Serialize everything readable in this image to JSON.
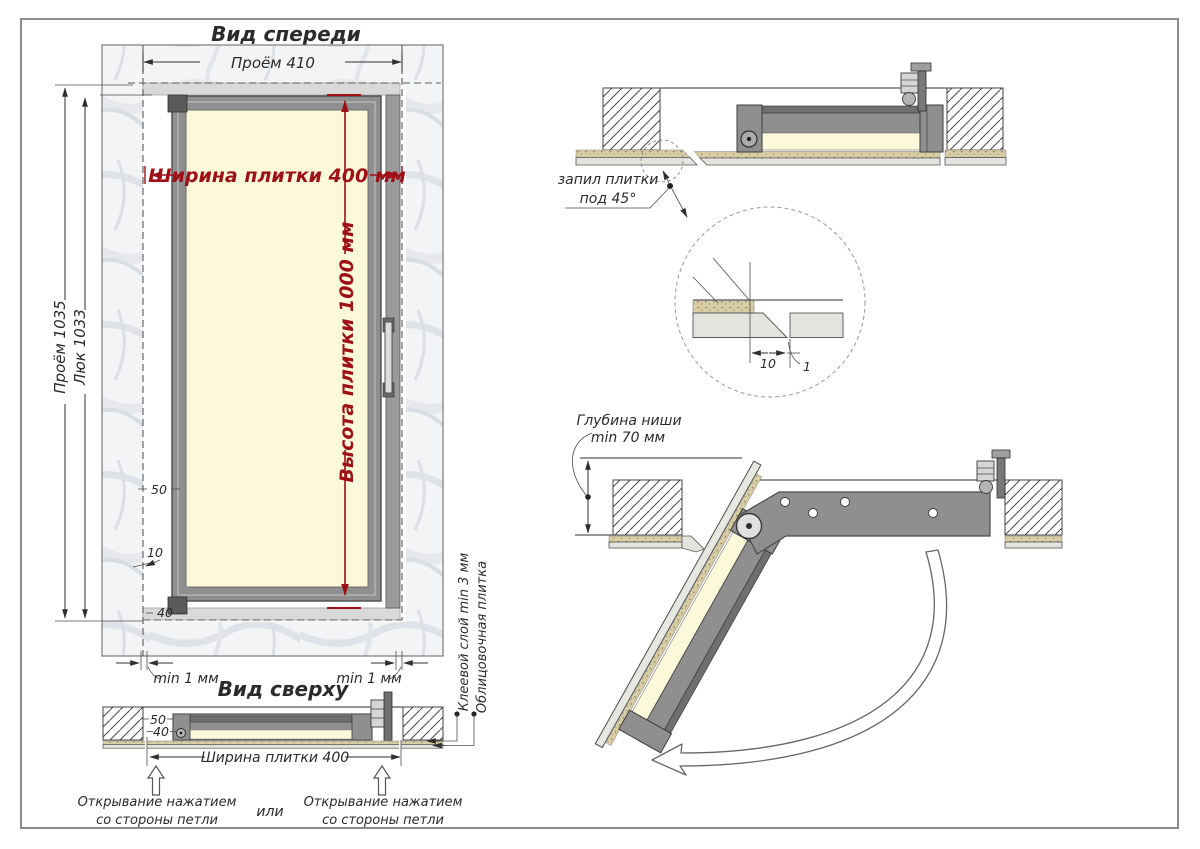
{
  "colors": {
    "red": "#9e1016",
    "frame_gray": "#8f8f8f",
    "frame_dark": "#4b4b4b",
    "cream": "#fcf8da",
    "tile_gray": "#e4e4df",
    "adhesive_tan": "#d9cda6",
    "marble_base": "#f4f5f7",
    "line": "#2f2f2f"
  },
  "front_view": {
    "title": "Вид спереди",
    "dim_opening_width": "Проём 410",
    "dim_tile_width": "Ширина плитки 400 мм",
    "dim_tile_height": "Высота плитки 1000 мм",
    "dim_opening_height": "Проём 1035",
    "dim_hatch_height": "Люк 1033",
    "dim_50": "50",
    "dim_10": "10",
    "dim_40": "40",
    "gap_left": "min 1 мм",
    "gap_right": "min 1 мм"
  },
  "top_view": {
    "title": "Вид сверху",
    "dim_50": "50",
    "dim_40": "40",
    "dim_tile_width": "Ширина плитки 400",
    "label_open_left_1": "Открывание нажатием",
    "label_open_left_2": "со стороны петли",
    "label_or": "или",
    "label_open_right_1": "Открывание нажатием",
    "label_open_right_2": "со стороны петли",
    "label_adhesive": "Клеевой слой min 3 мм",
    "label_tile": "Облицовочная плитка"
  },
  "section_closed": {
    "label_cut_1": "запил плитки",
    "label_cut_2": "под 45°"
  },
  "detail_view": {
    "dim_10": "10",
    "dim_1": "1"
  },
  "section_open": {
    "label_depth_1": "Глубина ниши",
    "label_depth_2": "min 70 мм"
  }
}
